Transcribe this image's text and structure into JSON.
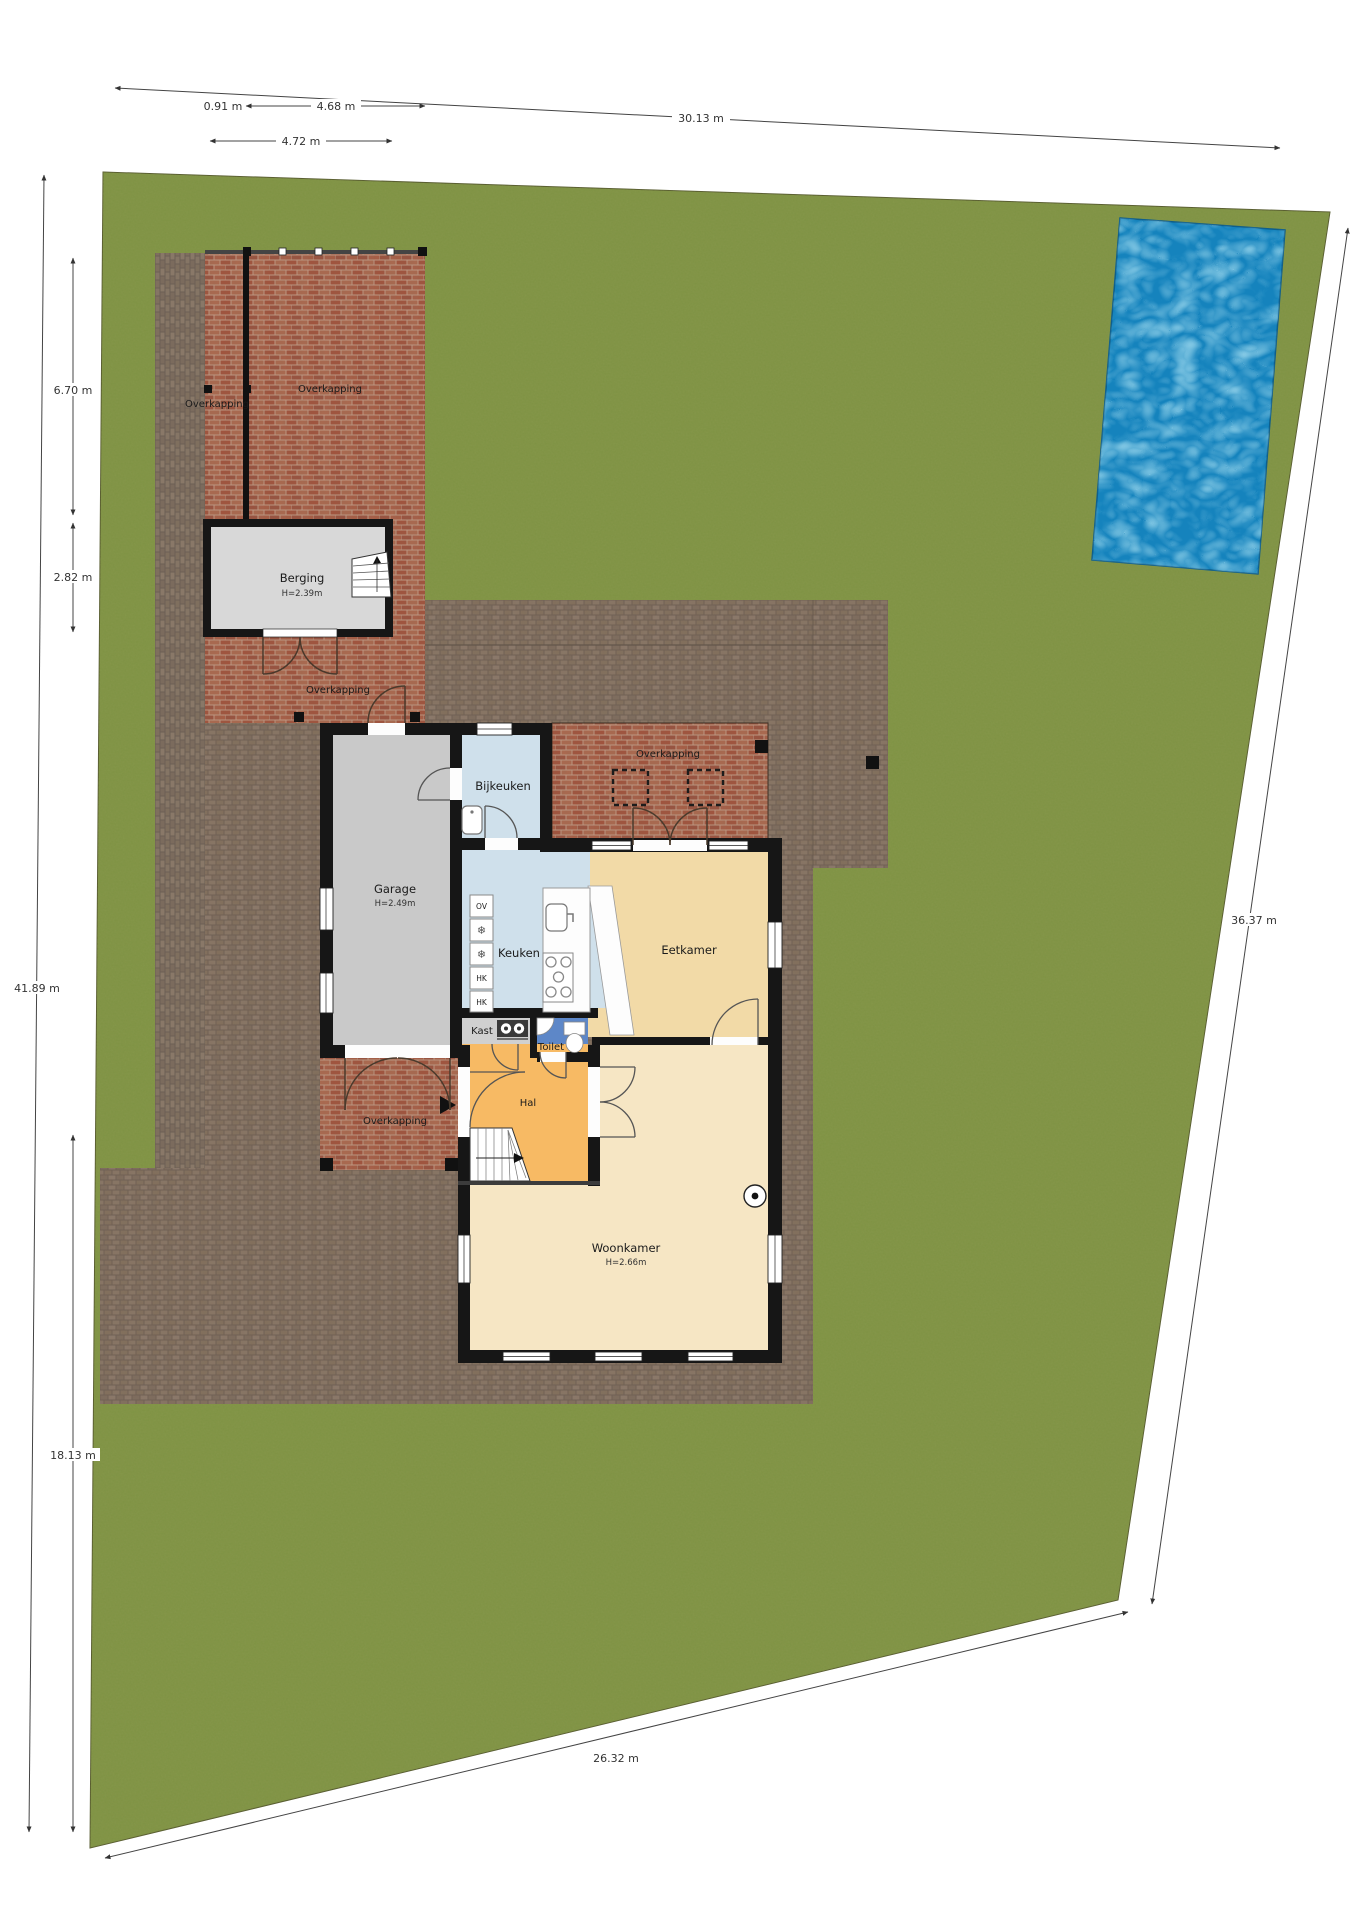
{
  "plan": {
    "rooms": {
      "berging": {
        "label": "Berging",
        "height": "H=2.39m"
      },
      "garage": {
        "label": "Garage",
        "height": "H=2.49m"
      },
      "bijkeuken": {
        "label": "Bijkeuken"
      },
      "keuken": {
        "label": "Keuken"
      },
      "eetkamer": {
        "label": "Eetkamer"
      },
      "kast": {
        "label": "Kast"
      },
      "toilet": {
        "label": "Toilet"
      },
      "hal": {
        "label": "Hal"
      },
      "woonkamer": {
        "label": "Woonkamer",
        "height": "H=2.66m"
      }
    },
    "areas": {
      "overkapping_drive_strip": "Overkapping",
      "overkapping_front": "Overkapping",
      "overkapping_shed_south": "Overkapping",
      "overkapping_terrace": "Overkapping",
      "overkapping_entrance": "Overkapping"
    },
    "appliances": {
      "oven": "OV",
      "freezer_top": "❄",
      "freezer_bottom": "❄",
      "hk_upper": "HK",
      "hk_lower": "HK"
    },
    "dimensions": {
      "top_total": "30.13 m",
      "top_offset": "0.91 m",
      "top_shed": "4.68 m",
      "top_shed_alt": "4.72 m",
      "left_overkapping": "6.70 m",
      "left_berging": "2.82 m",
      "left_total": "41.89 m",
      "left_lower": "18.13 m",
      "right_total": "36.37 m",
      "bottom_total": "26.32 m"
    },
    "colors": {
      "grass": "#7e9243",
      "paving": "#857466",
      "brick": "#a35a43",
      "pool": "#1d96cf",
      "wall": "#161616",
      "floor_garage": "#c9c9c9",
      "floor_berging": "#d8d8d8",
      "floor_keuken": "#cfe0eb",
      "floor_eetkamer": "#f2daa7",
      "floor_woonkamer": "#f6e6c4",
      "floor_hal": "#f7ba64",
      "floor_toilet": "#5d87c8",
      "floor_kast": "#d0d0d0"
    }
  }
}
